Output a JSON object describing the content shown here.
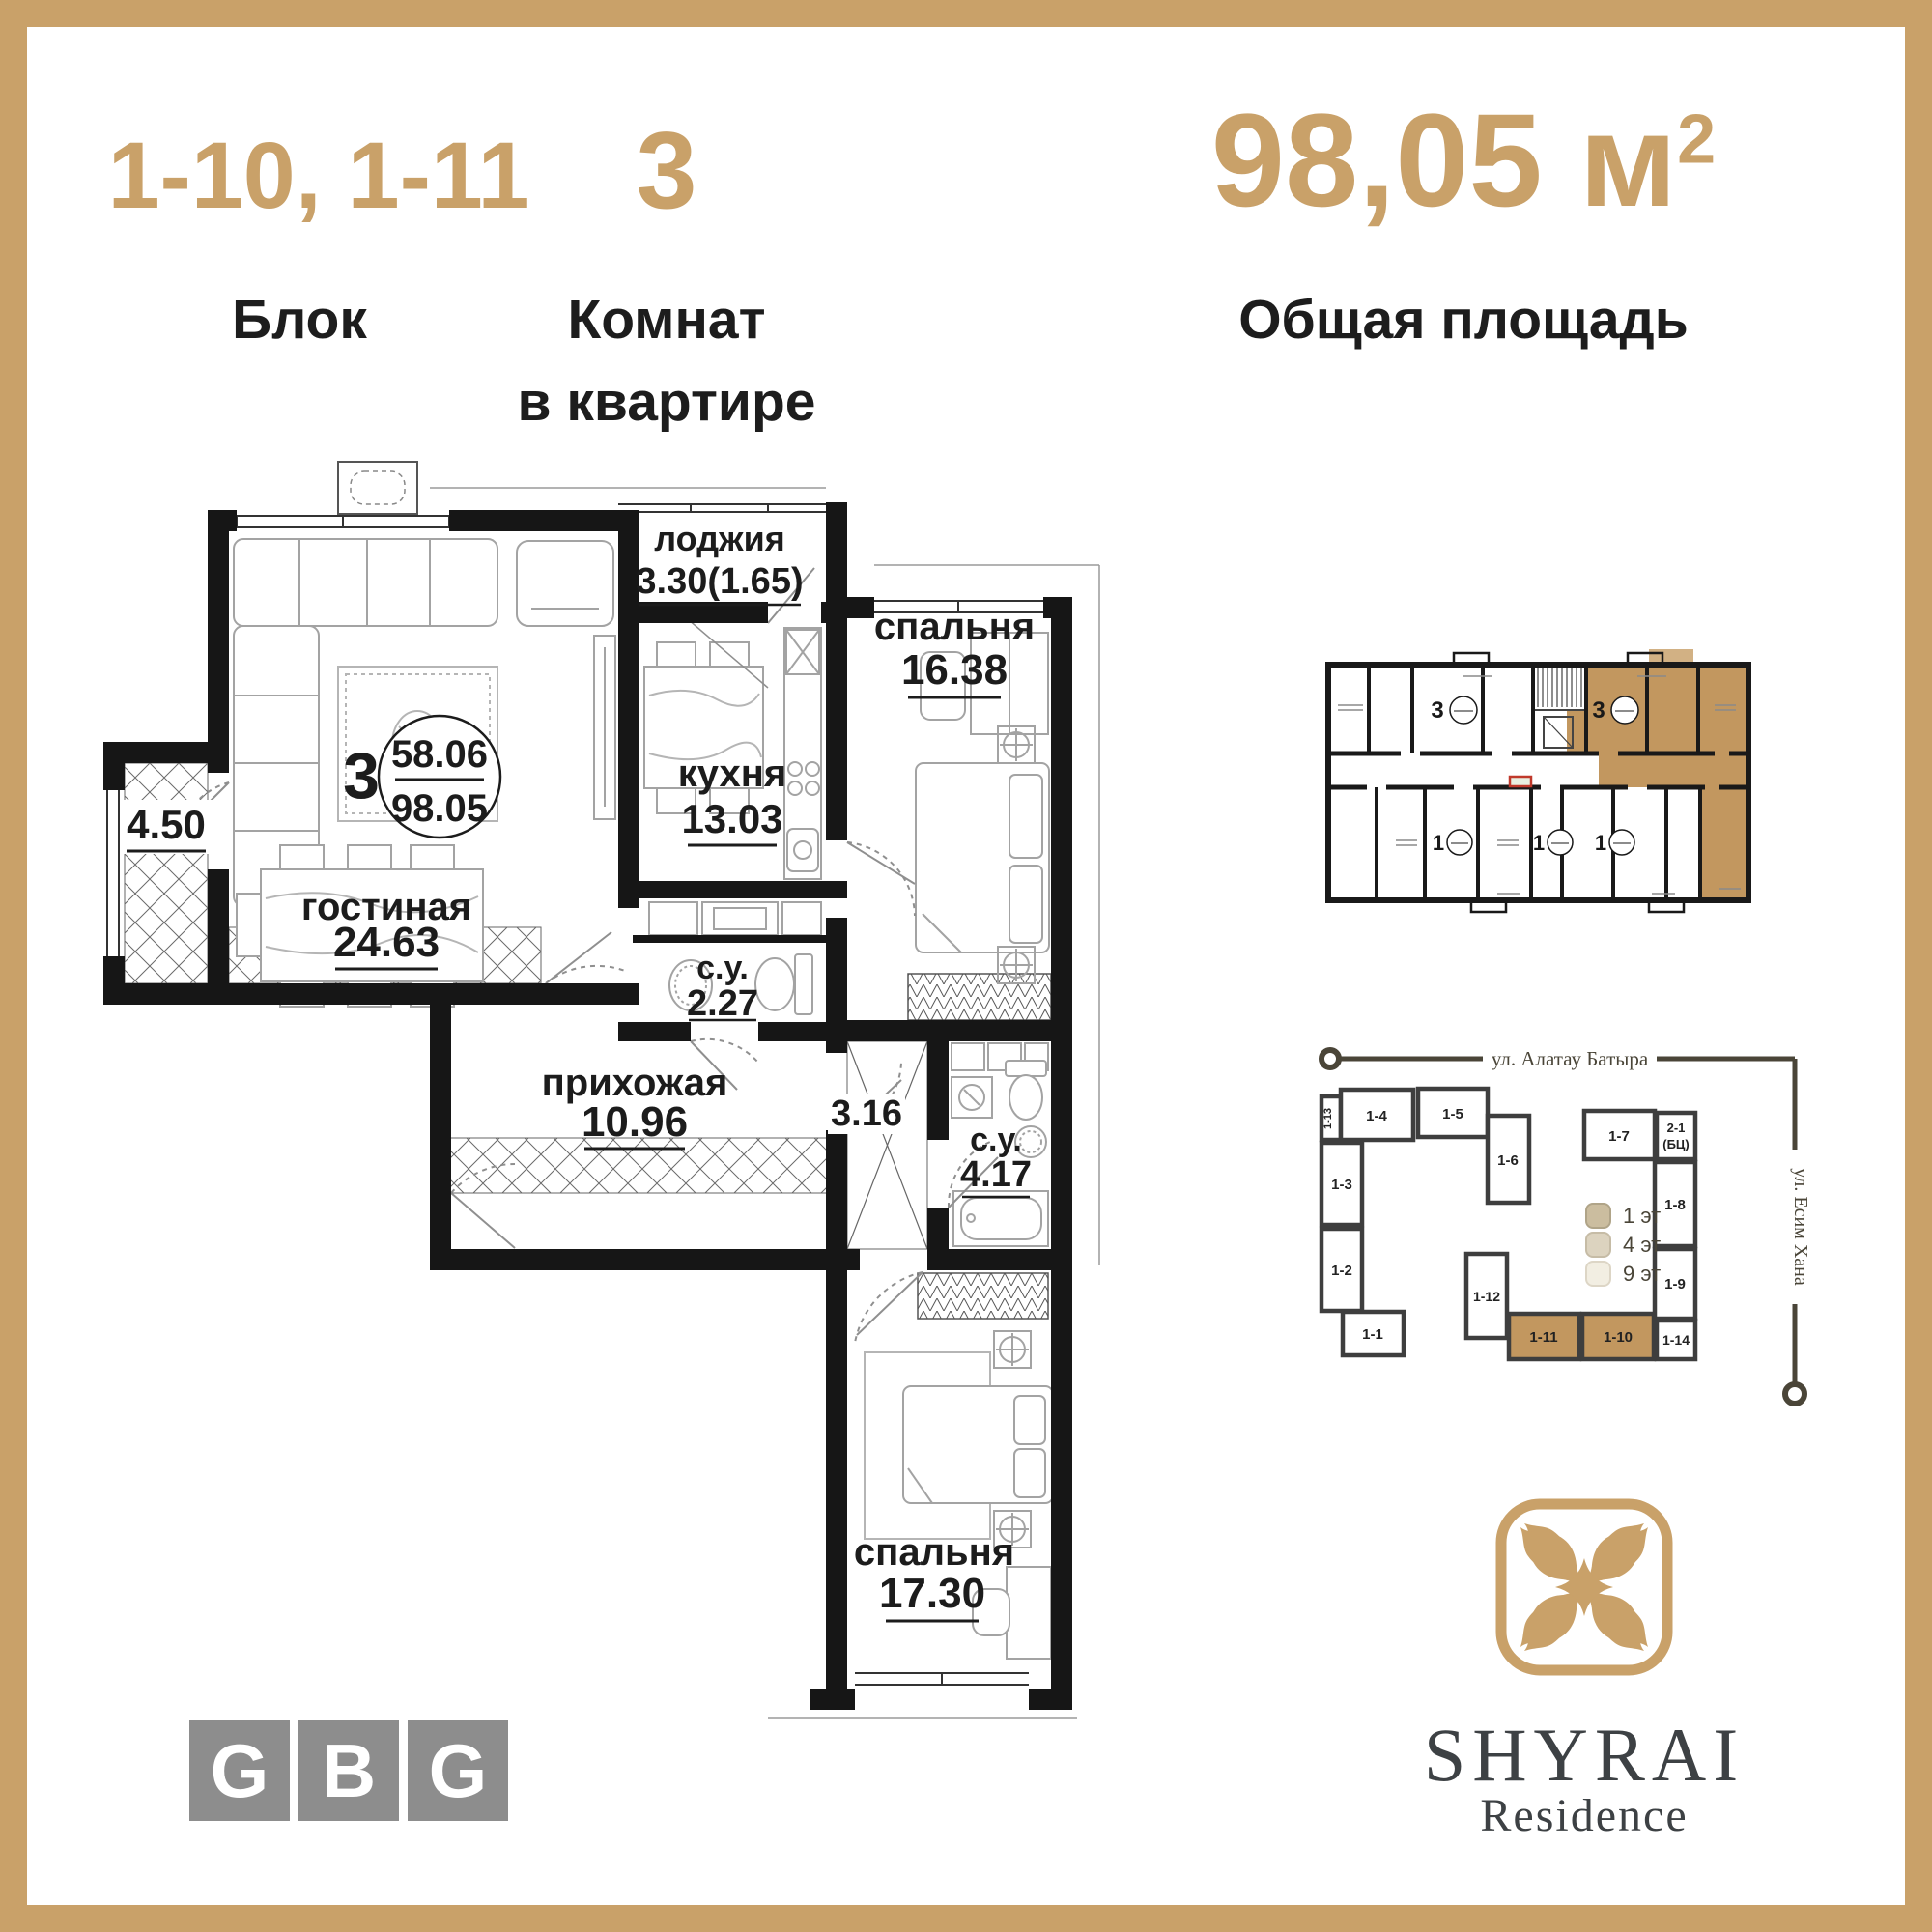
{
  "header": {
    "block_value": "1-10, 1-11",
    "block_label": "Блок",
    "rooms_value": "3",
    "rooms_label_1": "Комнат",
    "rooms_label_2": "в квартире",
    "area_value": "98,05 м",
    "area_sup": "2",
    "area_label": "Общая площадь"
  },
  "floorplan": {
    "rooms_count": "3",
    "living_area": "58.06",
    "total_area": "98.05",
    "loggia": {
      "name": "лоджия",
      "area": "3.30(1.65)"
    },
    "bedroom1": {
      "name": "спальня",
      "area": "16.38"
    },
    "kitchen": {
      "name": "кухня",
      "area": "13.03"
    },
    "living": {
      "name": "гостиная",
      "area": "24.63"
    },
    "closet_left": {
      "area": "4.50"
    },
    "bath1": {
      "name": "с.у.",
      "area": "2.27"
    },
    "hall": {
      "name": "прихожая",
      "area": "10.96"
    },
    "closet2": {
      "area": "3.16"
    },
    "bath2": {
      "name": "с.у.",
      "area": "4.17"
    },
    "bedroom2": {
      "name": "спальня",
      "area": "17.30"
    }
  },
  "keyplan": {
    "unit3_left": "3",
    "unit3_right": "3",
    "unit1_a": "1",
    "unit1_b": "1",
    "unit1_c": "1"
  },
  "siteplan": {
    "street_top": "ул. Алатау Батыра",
    "street_right": "ул. Есим Хана",
    "legend": [
      {
        "label": "1 эт",
        "color": "#cbbd9f"
      },
      {
        "label": "4 эт",
        "color": "#dcd3bf"
      },
      {
        "label": "9 эт",
        "color": "#f2eee2"
      }
    ],
    "buildings": [
      {
        "id": "1-13"
      },
      {
        "id": "1-4"
      },
      {
        "id": "1-5"
      },
      {
        "id": "1-6"
      },
      {
        "id": "1-3"
      },
      {
        "id": "1-2"
      },
      {
        "id": "1-1"
      },
      {
        "id": "1-12"
      },
      {
        "id": "1-11",
        "highlight": true
      },
      {
        "id": "1-10",
        "highlight": true
      },
      {
        "id": "1-7"
      },
      {
        "id": "2-1",
        "sub": "(БЦ)"
      },
      {
        "id": "1-8"
      },
      {
        "id": "1-9"
      },
      {
        "id": "1-14"
      }
    ]
  },
  "logos": {
    "gbg": [
      {
        "letter": "G"
      },
      {
        "letter": "B"
      },
      {
        "letter": "G"
      }
    ],
    "brand": "SHYRAI",
    "brand_sub": "Residence"
  },
  "colors": {
    "gold": "#c9a169",
    "tan_highlight": "#c2975f",
    "tan_light": "#d2b184",
    "wall": "#161616",
    "logo_gray": "#8d8d8d",
    "brand_text": "#3d4144",
    "street_line": "#4a4538"
  }
}
